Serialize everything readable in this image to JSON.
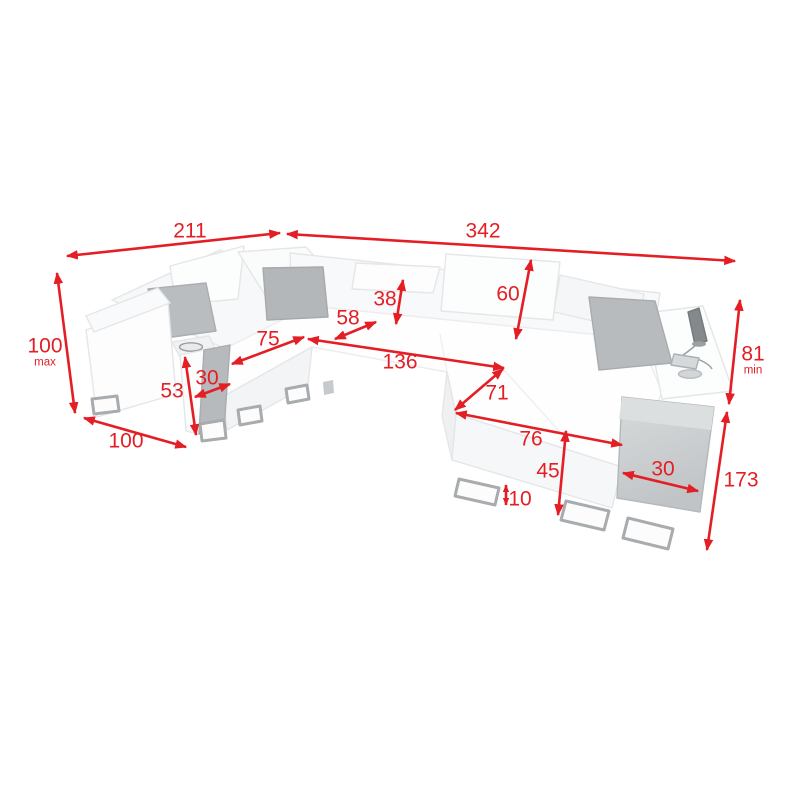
{
  "diagram": {
    "kind": "corner-sofa-dimension-drawing",
    "accent_color": "#e31e24",
    "dimensions": {
      "top_left_width": {
        "value": "211",
        "suffix": ""
      },
      "top_total_width": {
        "value": "342",
        "suffix": ""
      },
      "left_height": {
        "value": "100",
        "suffix": "max"
      },
      "left_arm_depth": {
        "value": "100",
        "suffix": ""
      },
      "left_console_height": {
        "value": "53",
        "suffix": ""
      },
      "left_console_width": {
        "value": "30",
        "suffix": ""
      },
      "left_seat_width": {
        "value": "75",
        "suffix": ""
      },
      "headrest_height": {
        "value": "38",
        "suffix": ""
      },
      "corner_seat_width": {
        "value": "58",
        "suffix": ""
      },
      "seat_length": {
        "value": "136",
        "suffix": ""
      },
      "backrest_height": {
        "value": "60",
        "suffix": ""
      },
      "chaise_width": {
        "value": "71",
        "suffix": ""
      },
      "chaise_length": {
        "value": "76",
        "suffix": ""
      },
      "seat_height": {
        "value": "45",
        "suffix": ""
      },
      "leg_height": {
        "value": "10",
        "suffix": ""
      },
      "right_console_width": {
        "value": "30",
        "suffix": ""
      },
      "right_min_height": {
        "value": "81",
        "suffix": "min"
      },
      "right_side_depth": {
        "value": "173",
        "suffix": ""
      }
    }
  }
}
